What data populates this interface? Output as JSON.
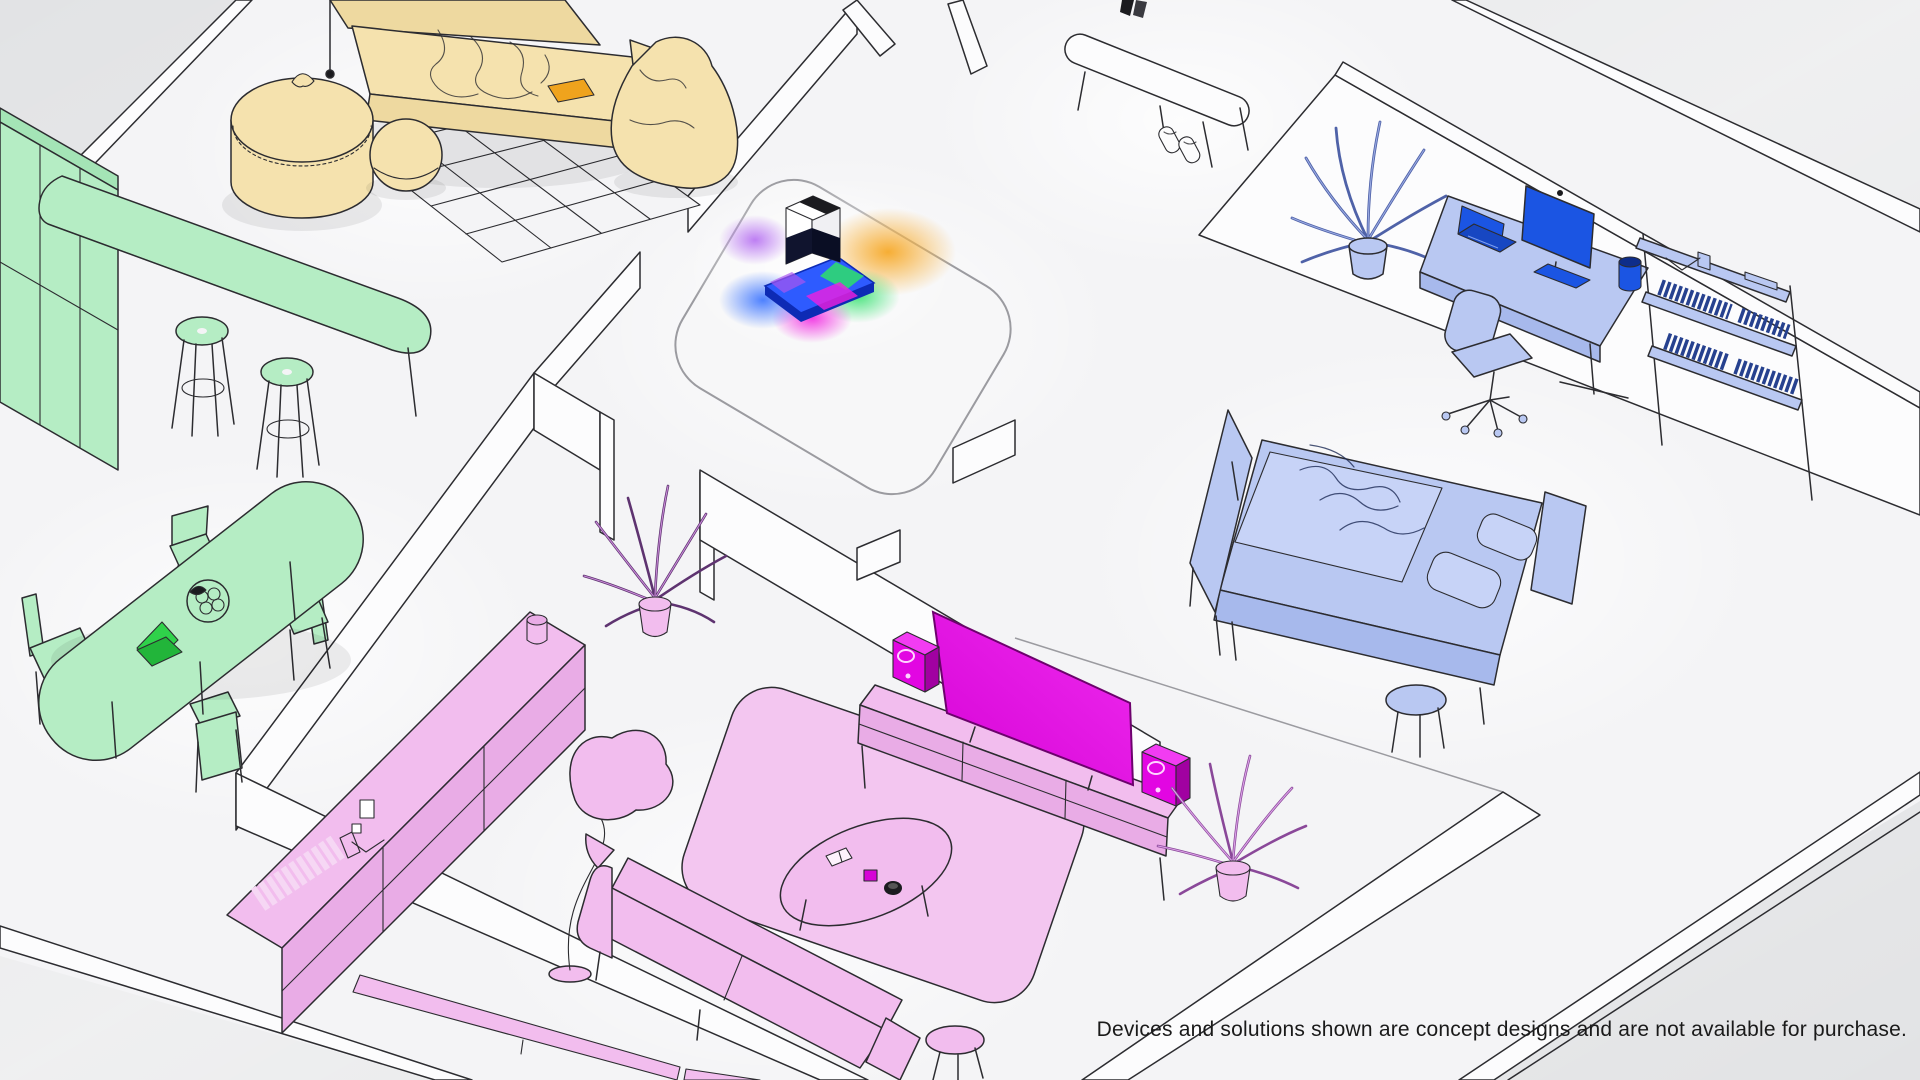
{
  "disclaimer": "Devices and solutions shown are concept designs and are not available for purchase.",
  "palette": {
    "bg_outer": "#e2e3e5",
    "bg_sheen": "#f7f7f8",
    "floor": "#f4f4f6",
    "wall": "#fcfcfd",
    "line": "#2c2c30",
    "soft_line": "#9b9ba0",
    "text_color": "#1a1a1a",
    "tan": "#f5e2ae",
    "tan_deep": "#eed9a0",
    "orange_accent": "#efa31d",
    "green": "#b5edc4",
    "green_deep": "#a4e4b6",
    "green_accent": "#2fd24a",
    "green_accent_dark": "#22b53a",
    "blue": "#b9c8f2",
    "blue_deep": "#a7b9ec",
    "blue_lighter": "#c7d3f7",
    "blue_accent": "#1b55e3",
    "blue_navy": "#10142e",
    "blue_books": "#26418f",
    "bed_fold": "#1d2a55",
    "plantblue_dark": "#4f62a8",
    "plantblue_soft": "#9aaae2",
    "pink": "#f2bdee",
    "pink_deep": "#e9ace6",
    "pink_rug": "#f3c6f0",
    "pink_books": "#f6d7f4",
    "magenta_screen": "#d603d6",
    "magenta_screen_hi": "#ef2bef",
    "magenta_speaker": "#e206e2",
    "magenta_dark": "#a101a1",
    "purple_dark": "#5e3370",
    "purple_soft": "#c98bd8",
    "pinkplant_dark": "#8a4899",
    "pinkplant_soft": "#dca3e8",
    "mat_blue": "#2e5bff",
    "mat_blue_dark": "#0d2bb5",
    "device_dark": "#1b1b1f",
    "glow_orange": "#f6a51e",
    "glow_green": "#2ee06a",
    "glow_magenta": "#f01fe0",
    "glow_blue": "#2f6bff",
    "glow_violet": "#a955f0"
  },
  "rooms": {
    "lounge": {
      "color": "tan",
      "items": [
        "daybed-sofa",
        "blanket",
        "orange-book",
        "bean-bag",
        "pouf-large",
        "pouf-round",
        "grid-rug",
        "wall-lamp"
      ]
    },
    "kitchen_dining": {
      "color": "green",
      "items": [
        "cabinet",
        "bar-counter",
        "bar-stool",
        "bar-stool",
        "dining-table",
        "fruit-bowl",
        "laptop",
        "chair",
        "chair",
        "chair",
        "chair"
      ]
    },
    "hallway": {
      "color": "white",
      "items": [
        "entry-bench",
        "shoes",
        "wall-hook",
        "hall-rug",
        "smart-device",
        "light-projection"
      ]
    },
    "bedroom_office": {
      "color": "blue",
      "items": [
        "palm-plant",
        "standing-desk",
        "monitor",
        "laptop",
        "speaker-cylinder",
        "office-chair",
        "bookshelf",
        "books",
        "bed",
        "duvet",
        "pillows",
        "headboard",
        "foot-bench",
        "side-stool"
      ]
    },
    "living": {
      "color": "pink",
      "items": [
        "sideboard",
        "books",
        "vase",
        "floor-lamp",
        "sofa",
        "stool",
        "area-rug",
        "coffee-table",
        "tv-console",
        "tv-screen",
        "speaker",
        "speaker",
        "palm-plant",
        "doorway-plant",
        "wall-bench"
      ]
    }
  }
}
